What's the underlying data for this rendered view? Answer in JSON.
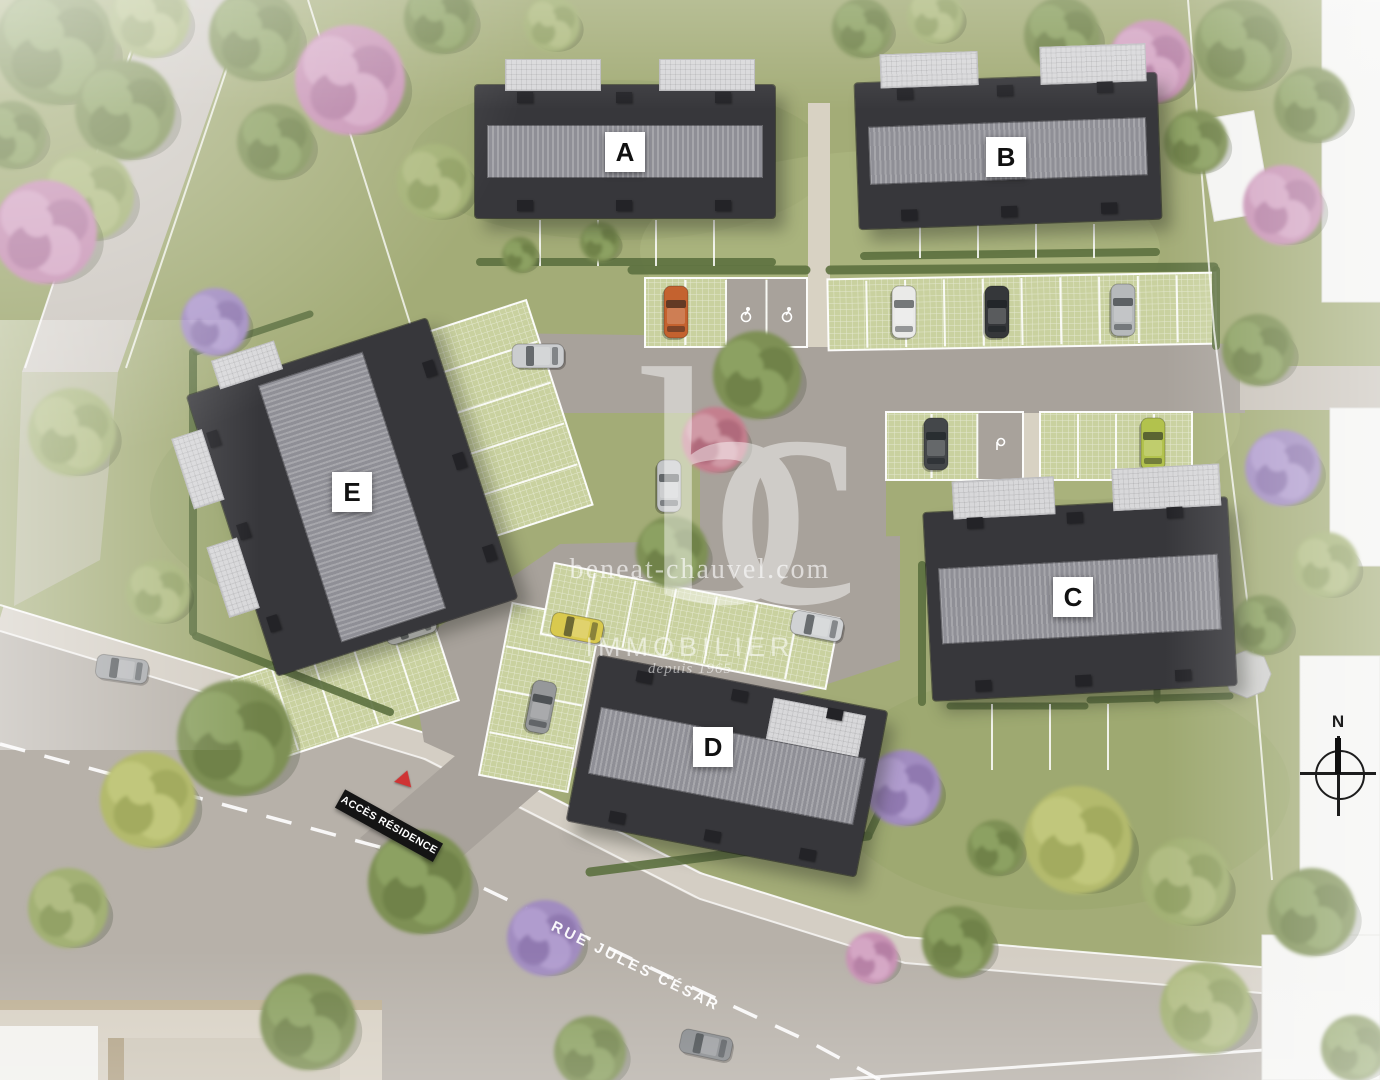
{
  "site": {
    "watermark": {
      "logo": "bc",
      "domain": "beneat-chauvel.com",
      "brand": "IMMOBILIER",
      "tagline": "depuis 1965"
    },
    "signs": {
      "access": "ACCÈS RÉSIDENCE",
      "street": "RUE JULES CÉSAR",
      "compass": "N"
    },
    "buildings": [
      {
        "id": "A",
        "label": "A"
      },
      {
        "id": "B",
        "label": "B"
      },
      {
        "id": "C",
        "label": "C"
      },
      {
        "id": "D",
        "label": "D"
      },
      {
        "id": "E",
        "label": "E"
      }
    ]
  },
  "palette": {
    "grass": "#a3ac77",
    "asphalt": "#a8a29b",
    "street": "#b7b1a9",
    "sidewalk": "#d4cec4",
    "road": "#cdc8c1",
    "paver": "#c9d19f",
    "hedge": "#5d7140",
    "plaza": "#d8d1c4",
    "white_building": "#f4f4f2",
    "roof_dark": "#37373b",
    "roof_band": "#a6a6ab",
    "accent_red": "#cf3434"
  },
  "scene": {
    "blotches": [
      [
        620,
        160,
        210,
        80,
        "#8f9c62",
        0.3
      ],
      [
        330,
        500,
        180,
        110,
        "#8f9c62",
        0.3
      ],
      [
        1060,
        790,
        230,
        120,
        "#96a368",
        0.33
      ],
      [
        470,
        950,
        200,
        90,
        "#8f9c62",
        0.25
      ],
      [
        900,
        250,
        260,
        100,
        "#b9c28c",
        0.3
      ],
      [
        1080,
        420,
        160,
        80,
        "#b9c28c",
        0.28
      ]
    ],
    "road_left": [
      [
        152,
        0
      ],
      [
        248,
        0
      ],
      [
        118,
        372
      ],
      [
        22,
        372
      ]
    ],
    "road_left_cont": [
      [
        22,
        372
      ],
      [
        118,
        372
      ],
      [
        100,
        560
      ],
      [
        14,
        606
      ]
    ],
    "street": [
      [
        0,
        631
      ],
      [
        425,
        759
      ],
      [
        700,
        899
      ],
      [
        905,
        963
      ],
      [
        1380,
        1003
      ],
      [
        1380,
        1080
      ],
      [
        0,
        1080
      ]
    ],
    "sidewalk": [
      [
        0,
        618
      ],
      [
        425,
        746
      ],
      [
        700,
        886
      ],
      [
        905,
        950
      ],
      [
        1380,
        990
      ]
    ],
    "sidewalk_top_line": [
      [
        0,
        605
      ],
      [
        425,
        733
      ],
      [
        700,
        873
      ],
      [
        905,
        937
      ],
      [
        1380,
        977
      ]
    ],
    "curb_line": [
      [
        0,
        631
      ],
      [
        425,
        759
      ],
      [
        700,
        899
      ],
      [
        905,
        963
      ],
      [
        1380,
        1003
      ]
    ],
    "center_dash": [
      [
        0,
        744
      ],
      [
        420,
        858
      ],
      [
        655,
        970
      ],
      [
        810,
        1042
      ],
      [
        880,
        1080
      ]
    ],
    "lane_line": [
      [
        830,
        1080
      ],
      [
        1380,
        1042
      ]
    ],
    "plaza": [
      [
        0,
        1008
      ],
      [
        382,
        1008
      ],
      [
        382,
        1080
      ],
      [
        0,
        1080
      ]
    ],
    "plaza_rects": [
      [
        0,
        1000,
        382,
        10,
        "#bfb196"
      ],
      [
        0,
        1026,
        98,
        54,
        "#f2f1ee"
      ],
      [
        108,
        1038,
        16,
        42,
        "#b2a387"
      ],
      [
        124,
        1038,
        216,
        42,
        "#cfc8ba"
      ]
    ],
    "asphalt": [
      [
        [
          435,
          332
        ],
        [
          1245,
          344
        ],
        [
          1245,
          413
        ],
        [
          435,
          413
        ]
      ],
      [
        [
          700,
          413
        ],
        [
          886,
          413
        ],
        [
          886,
          648
        ],
        [
          700,
          648
        ]
      ],
      [
        [
          408,
          648
        ],
        [
          560,
          544
        ],
        [
          900,
          536
        ],
        [
          900,
          660
        ],
        [
          520,
          786
        ],
        [
          424,
          742
        ]
      ],
      [
        [
          360,
          838
        ],
        [
          428,
          886
        ],
        [
          676,
          672
        ],
        [
          608,
          624
        ]
      ]
    ],
    "paths": [
      [
        808,
        103,
        22,
        244,
        "#d8d2c3"
      ],
      [
        1022,
        413,
        20,
        110,
        "#d8d2c3"
      ],
      [
        1240,
        366,
        140,
        44,
        "#c9c3ba"
      ]
    ],
    "stalls": [
      {
        "x": 645,
        "y": 278,
        "w": 162,
        "h": 69,
        "rot": 0,
        "dir": "v",
        "n": 4,
        "gray": [
          2,
          3
        ]
      },
      {
        "x": 828,
        "y": 276,
        "w": 388,
        "h": 71,
        "rot": -1,
        "dir": "v",
        "n": 10,
        "gray": []
      },
      {
        "x": 886,
        "y": 412,
        "w": 137,
        "h": 68,
        "rot": 0,
        "dir": "v",
        "n": 3,
        "gray": [
          2
        ]
      },
      {
        "x": 1040,
        "y": 412,
        "w": 152,
        "h": 68,
        "rot": 0,
        "dir": "v",
        "n": 4,
        "gray": []
      },
      {
        "x": 413,
        "y": 318,
        "w": 150,
        "h": 215,
        "rot": -18,
        "dir": "h",
        "n": 5,
        "gray": []
      },
      {
        "x": 240,
        "y": 645,
        "w": 210,
        "h": 90,
        "rot": -18,
        "dir": "v",
        "n": 5,
        "gray": []
      },
      {
        "x": 495,
        "y": 610,
        "w": 90,
        "h": 175,
        "rot": 11,
        "dir": "h",
        "n": 4,
        "gray": []
      },
      {
        "x": 545,
        "y": 590,
        "w": 290,
        "h": 72,
        "rot": 11,
        "dir": "v",
        "n": 7,
        "gray": []
      }
    ],
    "icons": [
      [
        746,
        314,
        "pmr"
      ],
      [
        787,
        314,
        "pmr"
      ],
      [
        480,
        528,
        "pmr"
      ],
      [
        1000,
        444,
        "ev"
      ]
    ],
    "hedges": [
      [
        632,
        270,
        806,
        270,
        9
      ],
      [
        830,
        270,
        1214,
        267,
        9
      ],
      [
        1216,
        270,
        1216,
        346,
        8
      ],
      [
        480,
        262,
        772,
        262,
        8
      ],
      [
        864,
        256,
        1156,
        252,
        8
      ],
      [
        922,
        565,
        922,
        702,
        8
      ],
      [
        950,
        706,
        1085,
        706,
        7
      ],
      [
        1157,
        645,
        1157,
        700,
        7
      ],
      [
        1090,
        700,
        1230,
        696,
        7
      ],
      [
        590,
        872,
        868,
        836,
        9
      ],
      [
        868,
        836,
        898,
        772,
        8
      ],
      [
        193,
        352,
        193,
        632,
        8
      ],
      [
        196,
        636,
        390,
        712,
        8
      ],
      [
        196,
        352,
        310,
        314,
        7
      ]
    ],
    "fences": [
      [
        540,
        220,
        540,
        266
      ],
      [
        598,
        220,
        598,
        266
      ],
      [
        656,
        220,
        656,
        266
      ],
      [
        714,
        220,
        714,
        266
      ],
      [
        920,
        224,
        920,
        258
      ],
      [
        978,
        224,
        978,
        258
      ],
      [
        1036,
        224,
        1036,
        258
      ],
      [
        1094,
        224,
        1094,
        258
      ],
      [
        992,
        704,
        992,
        770
      ],
      [
        1050,
        704,
        1050,
        770
      ],
      [
        1108,
        704,
        1108,
        770
      ]
    ],
    "boundaries": [
      [
        [
          308,
          0
        ],
        [
          420,
          355
        ],
        [
          470,
          540
        ]
      ],
      [
        [
          250,
          0
        ],
        [
          126,
          368
        ]
      ],
      [
        [
          148,
          0
        ],
        [
          25,
          368
        ]
      ],
      [
        [
          1188,
          0
        ],
        [
          1214,
          330
        ],
        [
          1252,
          640
        ],
        [
          1272,
          880
        ]
      ]
    ],
    "whites": [
      [
        1205,
        115,
        58,
        102,
        -10
      ],
      [
        1322,
        -8,
        60,
        310,
        0
      ],
      [
        1330,
        408,
        52,
        158,
        0
      ],
      [
        1300,
        656,
        80,
        424,
        0
      ],
      [
        1262,
        935,
        118,
        145,
        0
      ]
    ],
    "gazebo": "1271,674 1264,657 1247,650 1230,657 1223,674 1230,691 1247,698 1264,691",
    "trees": [
      [
        55,
        45,
        60,
        "g"
      ],
      [
        150,
        18,
        40,
        "l"
      ],
      [
        255,
        35,
        46,
        "g"
      ],
      [
        350,
        80,
        55,
        "p"
      ],
      [
        125,
        110,
        50,
        "g"
      ],
      [
        88,
        195,
        46,
        "l"
      ],
      [
        45,
        232,
        52,
        "p"
      ],
      [
        275,
        142,
        38,
        "g"
      ],
      [
        12,
        135,
        34,
        "g"
      ],
      [
        215,
        322,
        34,
        "v"
      ],
      [
        72,
        432,
        44,
        "l"
      ],
      [
        158,
        592,
        32,
        "l"
      ],
      [
        440,
        18,
        36,
        "g"
      ],
      [
        552,
        24,
        28,
        "l"
      ],
      [
        862,
        28,
        30,
        "g"
      ],
      [
        935,
        16,
        28,
        "l"
      ],
      [
        1062,
        35,
        38,
        "g"
      ],
      [
        1150,
        62,
        42,
        "p"
      ],
      [
        1240,
        45,
        46,
        "g"
      ],
      [
        1312,
        105,
        38,
        "g"
      ],
      [
        1196,
        142,
        32,
        "g"
      ],
      [
        1283,
        205,
        40,
        "p"
      ],
      [
        1258,
        350,
        36,
        "g"
      ],
      [
        1283,
        468,
        38,
        "v"
      ],
      [
        1326,
        565,
        33,
        "l"
      ],
      [
        1262,
        625,
        30,
        "g"
      ],
      [
        1312,
        912,
        44,
        "g"
      ],
      [
        1206,
        1008,
        46,
        "l"
      ],
      [
        1354,
        1048,
        33,
        "g"
      ],
      [
        757,
        375,
        44,
        "g"
      ],
      [
        715,
        440,
        33,
        "r"
      ],
      [
        672,
        552,
        36,
        "g"
      ],
      [
        435,
        182,
        38,
        "l"
      ],
      [
        600,
        242,
        20,
        "g"
      ],
      [
        520,
        255,
        18,
        "g"
      ],
      [
        903,
        788,
        38,
        "v"
      ],
      [
        958,
        942,
        36,
        "g"
      ],
      [
        872,
        958,
        26,
        "p"
      ],
      [
        1078,
        840,
        54,
        "y"
      ],
      [
        1186,
        882,
        44,
        "l"
      ],
      [
        995,
        848,
        28,
        "g"
      ],
      [
        235,
        738,
        58,
        "g"
      ],
      [
        148,
        800,
        48,
        "y"
      ],
      [
        420,
        882,
        52,
        "g"
      ],
      [
        545,
        938,
        38,
        "v"
      ],
      [
        308,
        1022,
        48,
        "g"
      ],
      [
        68,
        908,
        40,
        "l"
      ],
      [
        590,
        1052,
        36,
        "g"
      ]
    ],
    "cars": [
      [
        676,
        312,
        90,
        "#c4622f"
      ],
      [
        904,
        312,
        90,
        "#eaeae8"
      ],
      [
        997,
        312,
        90,
        "#35373a"
      ],
      [
        1123,
        310,
        90,
        "#b6b9bb"
      ],
      [
        936,
        444,
        90,
        "#44474a"
      ],
      [
        1153,
        444,
        90,
        "#b2c24d"
      ],
      [
        538,
        356,
        0,
        "#cbcdcf"
      ],
      [
        669,
        486,
        90,
        "#c2c4c6"
      ],
      [
        577,
        628,
        11,
        "#d9c94e"
      ],
      [
        817,
        626,
        11,
        "#d0d2d4"
      ],
      [
        410,
        627,
        -18,
        "#d6d6d4"
      ],
      [
        541,
        707,
        101,
        "#96989a"
      ],
      [
        122,
        669,
        8,
        "#a6a8aa"
      ],
      [
        706,
        1045,
        12,
        "#84878a"
      ]
    ]
  }
}
